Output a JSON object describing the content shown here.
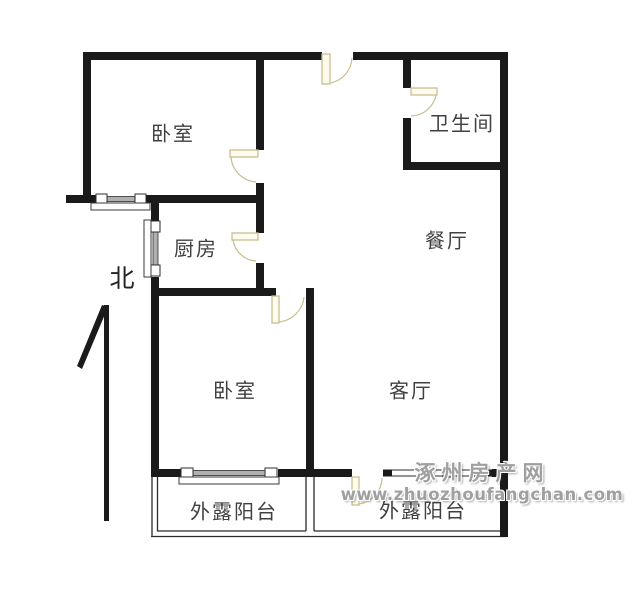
{
  "floor_plan": {
    "compass": {
      "label": "北"
    },
    "rooms": [
      {
        "id": "bedroom-1",
        "label": "卧室"
      },
      {
        "id": "bathroom",
        "label": "卫生间"
      },
      {
        "id": "kitchen",
        "label": "厨房"
      },
      {
        "id": "dining-room",
        "label": "餐厅"
      },
      {
        "id": "bedroom-2",
        "label": "卧室"
      },
      {
        "id": "living-room",
        "label": "客厅"
      },
      {
        "id": "balcony-left",
        "label": "外露阳台"
      },
      {
        "id": "balcony-right",
        "label": "外露阳台"
      }
    ],
    "watermark": {
      "site_name": "涿州房产网",
      "site_url": "www.zhuozhoufangchan.com"
    }
  },
  "colors": {
    "wall": "#1a1a1a",
    "door": "#c8bf8e",
    "label": "#404040",
    "watermark": "#a0a0a0",
    "window_gray": "#b0b0b0",
    "line": "#2a2a2a",
    "background": "#ffffff"
  }
}
